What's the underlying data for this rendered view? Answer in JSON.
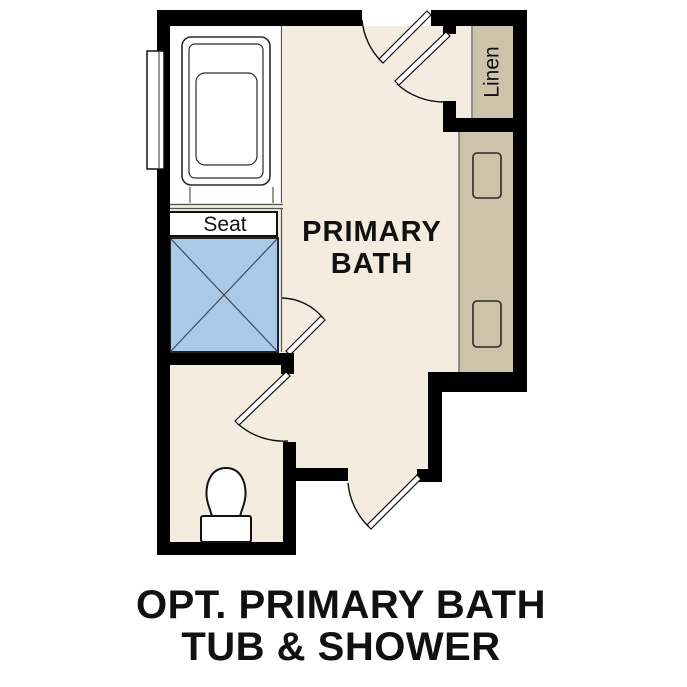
{
  "plan": {
    "room_label": {
      "line1": "PRIMARY",
      "line2": "BATH"
    },
    "seat_label": "Seat",
    "linen_label": "Linen"
  },
  "caption": {
    "line1": "OPT. PRIMARY BATH",
    "line2": "TUB & SHOWER"
  },
  "colors": {
    "wall": "#000000",
    "floor": "#f4ecdf",
    "cabinet": "#cdc3ab",
    "fixture_blue": "#aac9e9",
    "fixture_white": "#ffffff"
  }
}
